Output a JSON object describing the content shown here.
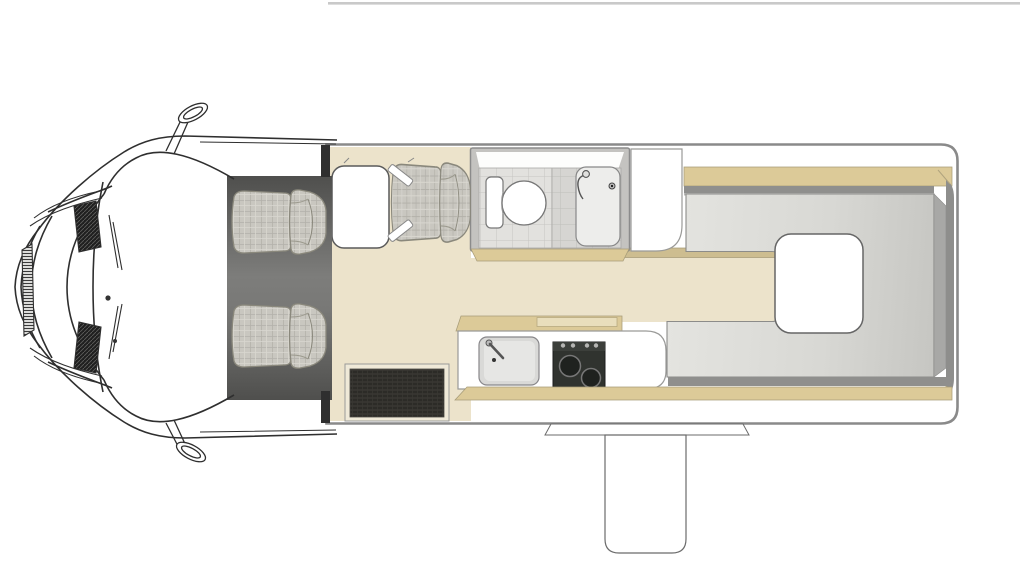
{
  "document": {
    "type": "vehicle-floorplan-diagram",
    "subject": "Top-down floor plan of a campervan / motorhome",
    "vehicle_front": "left",
    "visible_text": "none"
  },
  "colors": {
    "floor_beige": "#ece3cb",
    "furniture_tan": "#dcca98",
    "furniture_tan_dark": "#cdbd90",
    "furniture_tan_light": "#e9debc",
    "wall_gray": "#8a8a8a",
    "line_ink": "#2f2f2f",
    "rear_floor_light": "#e4e4e0",
    "rear_floor_dark": "#c3c3bf",
    "tile": "#e2e1de",
    "seat_fabric": "#c9c7c0",
    "cab_floor": "#5c5c5a",
    "mat_dark": "#2c2b27",
    "white": "#ffffff"
  },
  "areas": {
    "cab": {
      "name": "driver-cab",
      "fixtures": [
        "bonnet-line-art",
        "windshield-with-wipers",
        "two-side-mirrors",
        "driver-seat",
        "passenger-seat",
        "dark-cab-floor"
      ]
    },
    "front_dinette": {
      "name": "front-dinette",
      "fixtures": [
        "white-table",
        "single-upholstered-seat",
        "dark-entry-mat"
      ]
    },
    "bathroom": {
      "name": "washroom",
      "fixtures": [
        "tiled-floor",
        "toilet-with-cistern",
        "shower-tray-with-drain-and-hose",
        "tan-cabinet-front"
      ]
    },
    "wardrobe": {
      "name": "wardrobe-unit",
      "fixtures": [
        "white-rounded-cabinet"
      ]
    },
    "kitchen": {
      "name": "kitchen-galley",
      "fixtures": [
        "worktop",
        "sink-with-tap",
        "hob-two-burners-four-knobs",
        "tan-worktop-flap",
        "tan-plinth"
      ]
    },
    "rear_lounge": {
      "name": "rear-lounge",
      "fixtures": [
        "top-side-bench",
        "bottom-side-bench",
        "gray-recessed-floor",
        "white-pedestal-table",
        "beige-walkway"
      ]
    },
    "entrance": {
      "name": "entry-door",
      "fixtures": [
        "threshold-flare",
        "fold-out-step"
      ]
    },
    "roof": {
      "name": "awning-rail-line",
      "fixtures": [
        "thin-gray-top-line"
      ]
    }
  }
}
